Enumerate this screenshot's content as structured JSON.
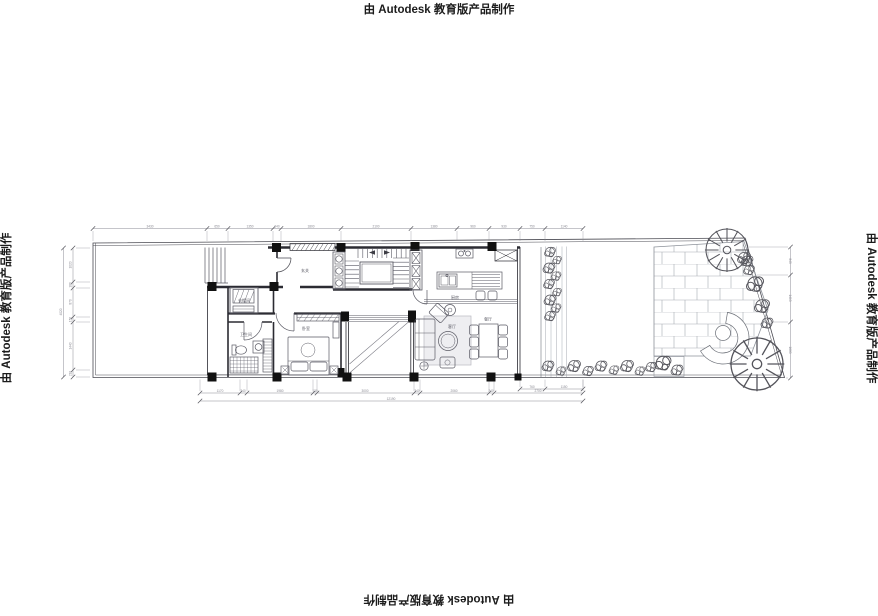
{
  "watermark": {
    "text": "由 Autodesk 教育版产品制作"
  },
  "plan": {
    "room_labels": {
      "entry": "玄关",
      "cloakroom": "衣帽间",
      "bathroom": "卫生间",
      "bedroom": "卧室",
      "kitchen": "厨房",
      "living": "客厅",
      "dining": "餐厅"
    },
    "dimensions": {
      "top": [
        "3430",
        "650",
        "1350",
        "240",
        "1800",
        "2100",
        "1380",
        "960",
        "930",
        "750",
        "1140"
      ],
      "left": [
        "1020",
        "180",
        "870",
        "150",
        "1440",
        "210"
      ],
      "left_total": "4020",
      "bottom": [
        "1170",
        "240",
        "1980",
        "130",
        "3000",
        "240",
        "2060",
        "240",
        "2700"
      ],
      "bottom_total": "12190",
      "right": [
        "840",
        "1410",
        "1680"
      ],
      "garden_bottom": [
        "760",
        "1150"
      ]
    }
  },
  "colors": {
    "line": "#3c3c44",
    "furniture": "#5a5a64",
    "dimension": "#8b8b94",
    "paving": "#a7abb2",
    "plant": "#55555c",
    "column": "#111111"
  }
}
